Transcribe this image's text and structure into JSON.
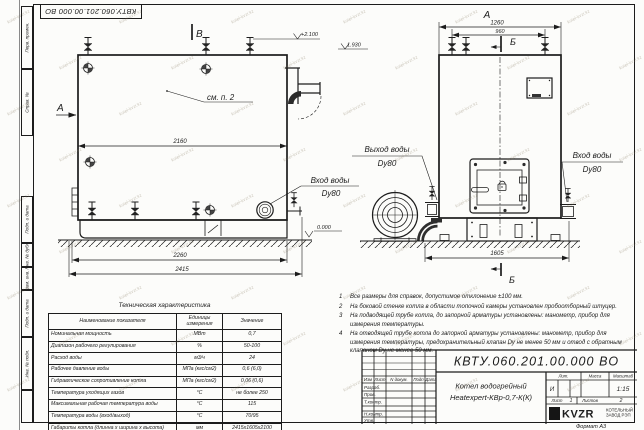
{
  "stamp_top": "КВТУ.060.201.00.000 ВО",
  "watermark": {
    "text": "kotel-kvzr.kz"
  },
  "margin_labels": [
    "Перв. примен.",
    "Справ. №",
    "Подп. и дата",
    "Инв. № дубл.",
    "Взам. инв. №",
    "Подп. и дата",
    "Инв. № подл."
  ],
  "views": {
    "left": {
      "section_a": "А",
      "section_b": "B",
      "see_note": "см. п. 2",
      "elev_top": "+2.100",
      "elev_chimney": "1.930",
      "elev_ground": "0.000",
      "dim_top": "2160",
      "dim_base": "2260",
      "dim_total": "2415",
      "inlet_label": "Вход воды",
      "inlet_dn": "Dy80"
    },
    "right": {
      "view_label": "А",
      "section_b": "Б",
      "dim_width": "1260",
      "dim_valves": "960",
      "dim_base": "1605",
      "outlet_label": "Выход воды",
      "outlet_dn": "Dy80",
      "inlet_label": "Вход воды",
      "inlet_dn": "Dy80"
    }
  },
  "notes": [
    {
      "num": "1",
      "text": "Все размеры для справок, допустимое отклонение ±100 мм."
    },
    {
      "num": "2",
      "text": "На боковой стенке котла в области топочной камеры установлен пробоотборный штуцер."
    },
    {
      "num": "3",
      "text": "На подводящей трубе котла, до запорной арматуры установлены: манометр, прибор для измерения температуры."
    },
    {
      "num": "4",
      "text": "На отводящей трубе котла до запорной арматуры установлены: манометр, прибор для измерения температуры, предохранительный клапан Dу не менее 50 мм и отвод с обратным клапаном Dу не менее 50 мм."
    }
  ],
  "tech_table": {
    "title": "Техническая характеристика",
    "headers": {
      "name": "Наименование показателя",
      "units": "Единицы измерения",
      "value": "Значение"
    },
    "rows": [
      {
        "name": "Номинальная мощность",
        "units": "МВт",
        "value": "0,7"
      },
      {
        "name": "Диапазон рабочего регулирования",
        "units": "%",
        "value": "50-100"
      },
      {
        "name": "Расход воды",
        "units": "м3/ч",
        "value": "24"
      },
      {
        "name": "Рабочее давление воды",
        "units": "МПа (кгс/см2)",
        "value": "0,6 (6,0)"
      },
      {
        "name": "Гидравлическое сопротивление котла",
        "units": "МПа (кгс/см2)",
        "value": "0,06 (0,6)"
      },
      {
        "name": "Температура уходящих газов",
        "units": "°С",
        "value": "не более 250"
      },
      {
        "name": "Максимальная рабочая температура воды",
        "units": "°С",
        "value": "115"
      },
      {
        "name": "Температура воды (вход/выход)",
        "units": "°С",
        "value": "70/95"
      },
      {
        "name": "Габариты котла (длинна х ширина х высота)",
        "units": "мм",
        "value": "2415х1605х2100"
      }
    ]
  },
  "title_block": {
    "doc_number": "КВТУ.060.201.00.000 ВО",
    "product_name_1": "Котел водогрейный",
    "product_name_2": "Heatexpert-КВр-0,7-К(К)",
    "header_cols": {
      "izm": "Изм",
      "list": "Лист",
      "doc": "N докум.",
      "podp": "Подп",
      "data": "Дата"
    },
    "row_labels": [
      "Разраб.",
      "Пров.",
      "Т.контр.",
      "Н.контр.",
      "Утв."
    ],
    "lit_label": "Лит.",
    "mass_label": "Масса",
    "scale_label": "Масштаб",
    "lit_value": "И",
    "scale_value": "1:15",
    "sheet_label": "Лист",
    "sheet_value": "1",
    "sheets_label": "Листов",
    "sheets_value": "2",
    "logo_text": "KVZR",
    "logo_sub1": "КОТЕЛЬНЫЙ",
    "logo_sub2": "ЗАВОД РЭП",
    "format_note": {
      "label": "Формат",
      "value": "А3"
    }
  }
}
